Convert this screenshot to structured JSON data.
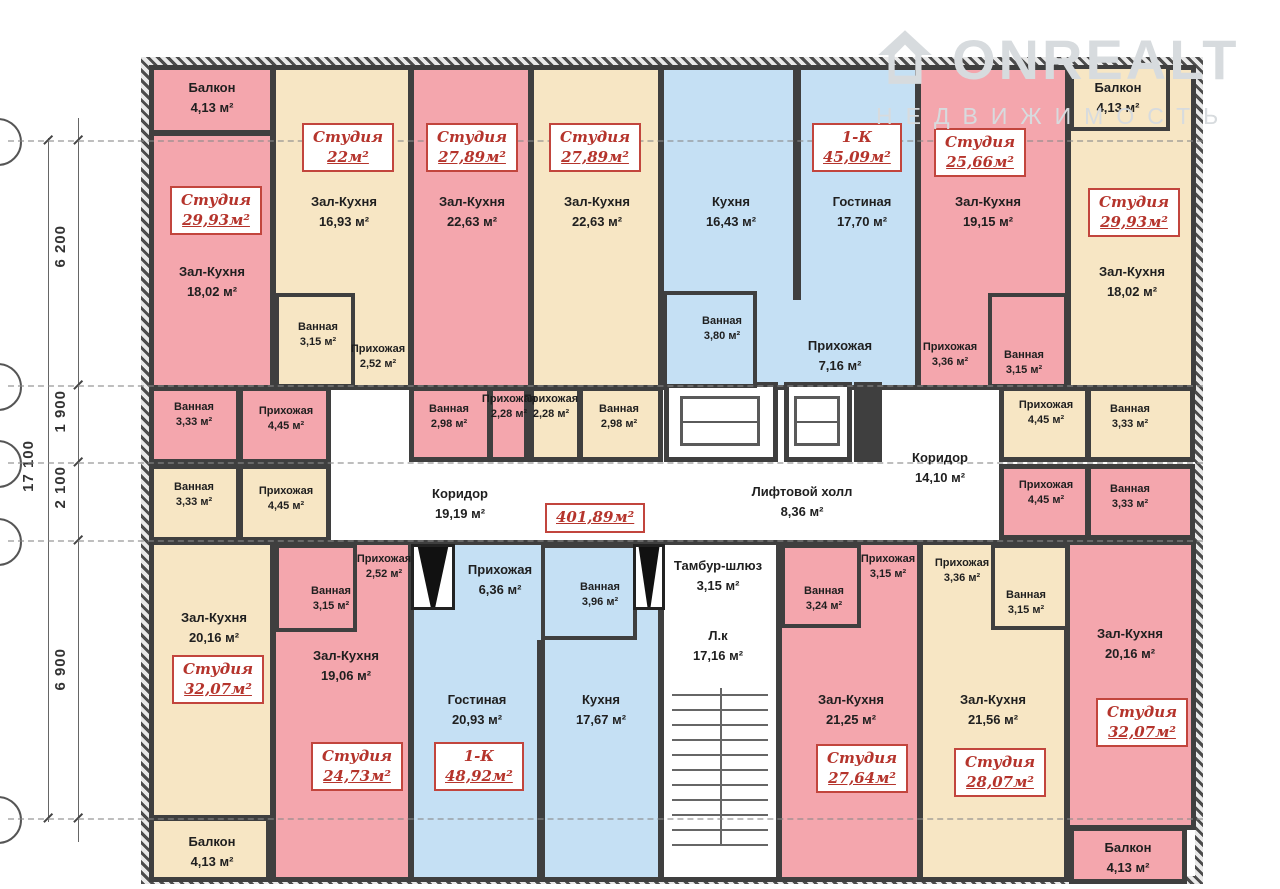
{
  "logo": {
    "brand": "ONREALT",
    "subtitle": "НЕДВИЖИМОСТЬ"
  },
  "summary": {
    "total_area": "401,89м²"
  },
  "dims": {
    "overall": "17 100",
    "d1": "6 200",
    "d2": "1 900",
    "d3": "2 100",
    "d4": "6 900"
  },
  "colors": {
    "studio_pink": "#f4a6ad",
    "cream": "#f7e6c4",
    "blue": "#c5e0f4",
    "wall": "#3f3f3f",
    "label_red": "#b5342c"
  },
  "units": {
    "a1": {
      "type": "Студия",
      "area": "29,93м²"
    },
    "a2": {
      "type": "Студия",
      "area": "22м²"
    },
    "a3": {
      "type": "Студия",
      "area": "27,89м²"
    },
    "a4": {
      "type": "Студия",
      "area": "27,89м²"
    },
    "a5": {
      "type": "1-К",
      "area": "45,09м²"
    },
    "a6": {
      "type": "Студия",
      "area": "25,66м²"
    },
    "a7": {
      "type": "Студия",
      "area": "29,93м²"
    },
    "b1": {
      "type": "Студия",
      "area": "32,07м²"
    },
    "b2": {
      "type": "Студия",
      "area": "24,73м²"
    },
    "b3": {
      "type": "1-К",
      "area": "48,92м²"
    },
    "b4": {
      "type": "Студия",
      "area": "27,64м²"
    },
    "b5": {
      "type": "Студия",
      "area": "28,07м²"
    },
    "b6": {
      "type": "Студия",
      "area": "32,07м²"
    }
  },
  "rooms": {
    "a1_balcony": {
      "name": "Балкон",
      "area": "4,13 м²"
    },
    "a1_hall": {
      "name": "Зал-Кухня",
      "area": "18,02 м²"
    },
    "a1_bath": {
      "name": "Ванная",
      "area": "3,33 м²"
    },
    "a1_entry": {
      "name": "Прихожая",
      "area": "4,45 м²"
    },
    "a2_hall": {
      "name": "Зал-Кухня",
      "area": "16,93 м²"
    },
    "a2_bath": {
      "name": "Ванная",
      "area": "3,15 м²"
    },
    "a2_entry": {
      "name": "Прихожая",
      "area": "2,52 м²"
    },
    "a3_hall": {
      "name": "Зал-Кухня",
      "area": "22,63 м²"
    },
    "a3_bath": {
      "name": "Ванная",
      "area": "2,98 м²"
    },
    "a3_entry": {
      "name": "Прихожая",
      "area": "2,28 м²"
    },
    "a4_hall": {
      "name": "Зал-Кухня",
      "area": "22,63 м²"
    },
    "a4_entry": {
      "name": "Прихожая",
      "area": "2,28 м²"
    },
    "a4_bath": {
      "name": "Ванная",
      "area": "2,98 м²"
    },
    "a5_kitchen": {
      "name": "Кухня",
      "area": "16,43 м²"
    },
    "a5_living": {
      "name": "Гостиная",
      "area": "17,70 м²"
    },
    "a5_bath": {
      "name": "Ванная",
      "area": "3,80 м²"
    },
    "a5_entry": {
      "name": "Прихожая",
      "area": "7,16 м²"
    },
    "a6_hall": {
      "name": "Зал-Кухня",
      "area": "19,15 м²"
    },
    "a6_entry": {
      "name": "Прихожая",
      "area": "3,36 м²"
    },
    "a6_bath": {
      "name": "Ванная",
      "area": "3,15 м²"
    },
    "a7_balcony": {
      "name": "Балкон",
      "area": "4,13 м²"
    },
    "a7_hall": {
      "name": "Зал-Кухня",
      "area": "18,02 м²"
    },
    "a7_entry": {
      "name": "Прихожая",
      "area": "4,45 м²"
    },
    "a7_bath": {
      "name": "Ванная",
      "area": "3,33 м²"
    },
    "b1_bath": {
      "name": "Ванная",
      "area": "3,33 м²"
    },
    "b1_entry": {
      "name": "Прихожая",
      "area": "4,45 м²"
    },
    "b1_hall": {
      "name": "Зал-Кухня",
      "area": "20,16 м²"
    },
    "b1_balcony": {
      "name": "Балкон",
      "area": "4,13 м²"
    },
    "b2_entry": {
      "name": "Прихожая",
      "area": "2,52 м²"
    },
    "b2_bath": {
      "name": "Ванная",
      "area": "3,15 м²"
    },
    "b2_hall": {
      "name": "Зал-Кухня",
      "area": "19,06 м²"
    },
    "b3_entry": {
      "name": "Прихожая",
      "area": "6,36 м²"
    },
    "b3_bath": {
      "name": "Ванная",
      "area": "3,96 м²"
    },
    "b3_living": {
      "name": "Гостиная",
      "area": "20,93 м²"
    },
    "b3_kitchen": {
      "name": "Кухня",
      "area": "17,67 м²"
    },
    "b4_bath": {
      "name": "Ванная",
      "area": "3,24 м²"
    },
    "b4_entry": {
      "name": "Прихожая",
      "area": "3,15 м²"
    },
    "b4_hall": {
      "name": "Зал-Кухня",
      "area": "21,25 м²"
    },
    "b5_entry": {
      "name": "Прихожая",
      "area": "3,36 м²"
    },
    "b5_bath": {
      "name": "Ванная",
      "area": "3,15 м²"
    },
    "b5_hall": {
      "name": "Зал-Кухня",
      "area": "21,56 м²"
    },
    "b6_hall": {
      "name": "Зал-Кухня",
      "area": "20,16 м²"
    },
    "b6_entry": {
      "name": "Прихожая",
      "area": "4,45 м²"
    },
    "b6_bath": {
      "name": "Ванная",
      "area": "3,33 м²"
    },
    "b6_balcony": {
      "name": "Балкон",
      "area": "4,13 м²"
    }
  },
  "common": {
    "corridor_left": {
      "name": "Коридор",
      "area": "19,19 м²"
    },
    "lift_hall": {
      "name": "Лифтовой холл",
      "area": "8,36 м²"
    },
    "corridor_right": {
      "name": "Коридор",
      "area": "14,10 м²"
    },
    "tambour": {
      "name": "Тамбур-шлюз",
      "area": "3,15 м²"
    },
    "stairs": {
      "name": "Л.к",
      "area": "17,16 м²"
    }
  }
}
